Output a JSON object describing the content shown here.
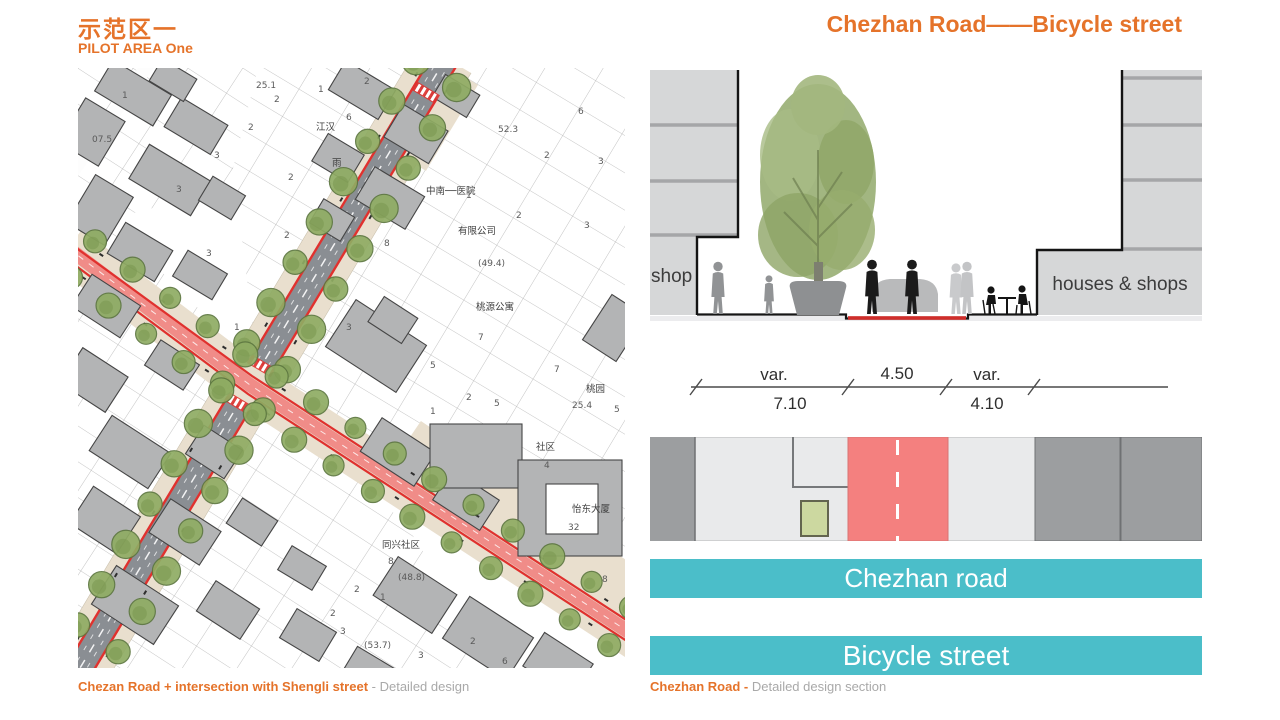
{
  "header": {
    "title_zh": "示范区一",
    "title_en": "PILOT AREA One",
    "right_title": "Chezhan Road——Bicycle street"
  },
  "map": {
    "caption_bold": "Chezan Road + intersection with Shengli street",
    "caption_rest": " - Detailed design",
    "number_labels": [
      {
        "t": "1",
        "x": 44,
        "y": 30
      },
      {
        "t": "25.1",
        "x": 178,
        "y": 20
      },
      {
        "t": "2",
        "x": 196,
        "y": 34
      },
      {
        "t": "1",
        "x": 240,
        "y": 24
      },
      {
        "t": "2",
        "x": 286,
        "y": 16
      },
      {
        "t": "6",
        "x": 268,
        "y": 52
      },
      {
        "t": "2",
        "x": 170,
        "y": 62
      },
      {
        "t": "3",
        "x": 136,
        "y": 90
      },
      {
        "t": "3",
        "x": 98,
        "y": 124
      },
      {
        "t": "07.5",
        "x": 14,
        "y": 74
      },
      {
        "t": "江汉",
        "x": 238,
        "y": 62,
        "zh": true
      },
      {
        "t": "2",
        "x": 210,
        "y": 112
      },
      {
        "t": "雨",
        "x": 254,
        "y": 98,
        "zh": true
      },
      {
        "t": "3",
        "x": 128,
        "y": 188
      },
      {
        "t": "2",
        "x": 206,
        "y": 170
      },
      {
        "t": "52.3",
        "x": 420,
        "y": 64
      },
      {
        "t": "2",
        "x": 466,
        "y": 90
      },
      {
        "t": "3",
        "x": 520,
        "y": 96
      },
      {
        "t": "6",
        "x": 500,
        "y": 46
      },
      {
        "t": "1",
        "x": 388,
        "y": 130
      },
      {
        "t": "2",
        "x": 438,
        "y": 150
      },
      {
        "t": "3",
        "x": 506,
        "y": 160
      },
      {
        "t": "中南──医院",
        "x": 348,
        "y": 126,
        "zh": true
      },
      {
        "t": "有限公司",
        "x": 380,
        "y": 166,
        "zh": true
      },
      {
        "t": "(49.4)",
        "x": 400,
        "y": 198
      },
      {
        "t": "8",
        "x": 306,
        "y": 178
      },
      {
        "t": "桃源公寓",
        "x": 398,
        "y": 242,
        "zh": true
      },
      {
        "t": "7",
        "x": 400,
        "y": 272
      },
      {
        "t": "7",
        "x": 476,
        "y": 304
      },
      {
        "t": "桃园",
        "x": 508,
        "y": 324,
        "zh": true
      },
      {
        "t": "25.4",
        "x": 494,
        "y": 340
      },
      {
        "t": "5",
        "x": 536,
        "y": 344
      },
      {
        "t": "3",
        "x": 268,
        "y": 262
      },
      {
        "t": "1",
        "x": 156,
        "y": 262
      },
      {
        "t": "2",
        "x": 190,
        "y": 248
      },
      {
        "t": "2",
        "x": 388,
        "y": 332
      },
      {
        "t": "1",
        "x": 352,
        "y": 346
      },
      {
        "t": "5",
        "x": 416,
        "y": 338
      },
      {
        "t": "社区",
        "x": 458,
        "y": 382,
        "zh": true
      },
      {
        "t": "4",
        "x": 466,
        "y": 400
      },
      {
        "t": "怡东大厦",
        "x": 494,
        "y": 444,
        "zh": true
      },
      {
        "t": "32",
        "x": 490,
        "y": 462
      },
      {
        "t": "同兴社区",
        "x": 304,
        "y": 480,
        "zh": true
      },
      {
        "t": "8",
        "x": 310,
        "y": 496
      },
      {
        "t": "(48.8)",
        "x": 320,
        "y": 512
      },
      {
        "t": "2",
        "x": 276,
        "y": 524
      },
      {
        "t": "1",
        "x": 302,
        "y": 532
      },
      {
        "t": "2",
        "x": 252,
        "y": 548
      },
      {
        "t": "3",
        "x": 262,
        "y": 566
      },
      {
        "t": "(53.7)",
        "x": 286,
        "y": 580
      },
      {
        "t": "3",
        "x": 340,
        "y": 590
      },
      {
        "t": "2",
        "x": 392,
        "y": 576
      },
      {
        "t": "6",
        "x": 424,
        "y": 596
      },
      {
        "t": "8",
        "x": 524,
        "y": 514
      },
      {
        "t": "5",
        "x": 352,
        "y": 300
      }
    ]
  },
  "section": {
    "left_label": "shop",
    "right_label": "houses & shops",
    "caption_bold": "Chezhan Road - ",
    "caption_rest": "Detailed design section"
  },
  "dimension": {
    "above": [
      "var.",
      "4.50",
      "var."
    ],
    "below": [
      "7.10",
      "4.10"
    ]
  },
  "banners": {
    "road": "Chezhan road",
    "street": "Bicycle street"
  },
  "colors": {
    "accent": "#e5732a",
    "teal": "#4bbec9",
    "plan_red": "#f4807f",
    "lane_red": "#e0312e",
    "caption_gray": "#a9a9a9"
  }
}
